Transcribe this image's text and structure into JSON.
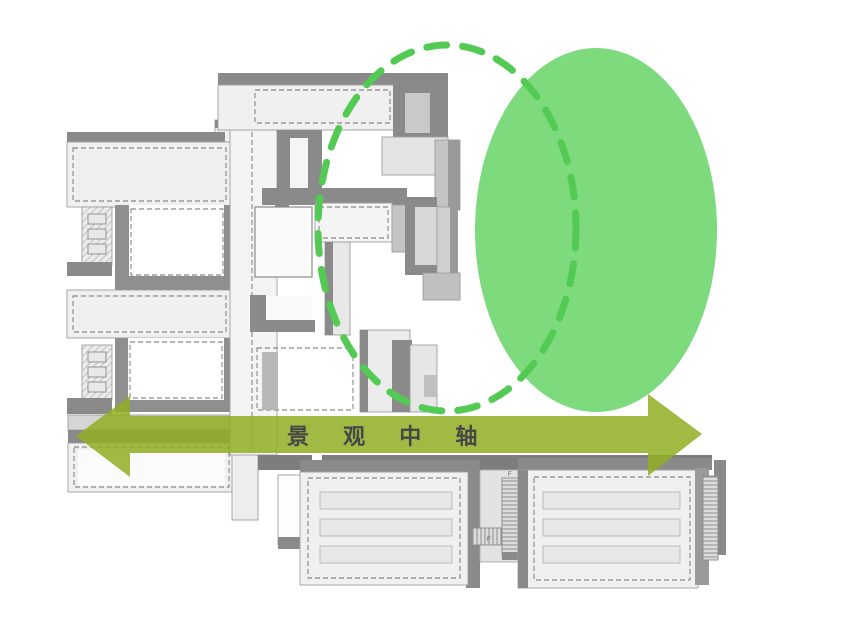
{
  "diagram": {
    "type": "architectural-landscape-axis-concept",
    "axis": {
      "label": "景 观 中 轴",
      "direction": "horizontal-double-headed"
    },
    "green_space": {
      "solid_ellipse": "main landscape green area",
      "dashed_ellipse": "landscape influence boundary"
    },
    "stair_labels": {
      "f1": "F",
      "f2": "F"
    },
    "colors": {
      "background": "#ffffff",
      "green_area_fill": "#7ddb7d",
      "green_dashed_stroke": "#53ca53",
      "axis_arrow_fill": "#8fae22",
      "axis_text_color": "#474747",
      "building_face": "#f0f0f0",
      "building_shadow": "#8a8a8a",
      "courtyard_white": "#ffffff"
    }
  }
}
